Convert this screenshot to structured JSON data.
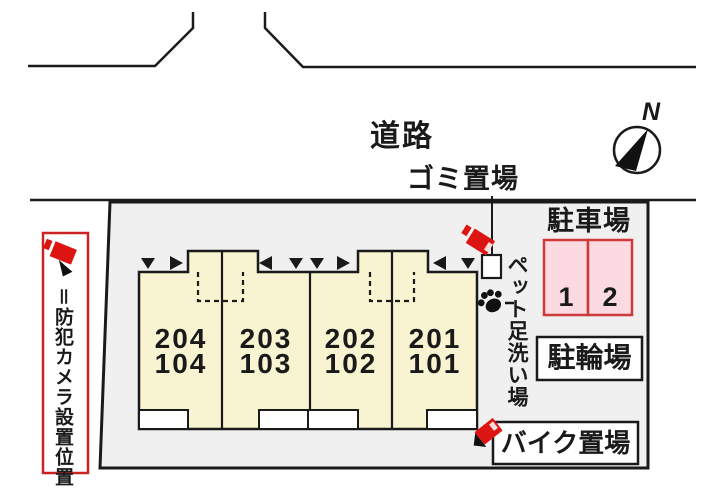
{
  "diagram": {
    "road_label": "道路",
    "garbage_label": "ゴミ置場",
    "north_label": "N",
    "parking": {
      "title": "駐車場",
      "spaces": [
        "1",
        "2"
      ]
    },
    "bicycle_label": "駐輪場",
    "bike_label": "バイク置場",
    "pet_wash_label": "ペット足洗い場",
    "legend_text": "＝防犯カメラ設置位置",
    "units": [
      {
        "upper": "204",
        "lower": "104"
      },
      {
        "upper": "203",
        "lower": "103"
      },
      {
        "upper": "202",
        "lower": "102"
      },
      {
        "upper": "201",
        "lower": "101"
      }
    ],
    "markers": [
      "down",
      "right",
      "left",
      "down",
      "down",
      "right",
      "left",
      "down"
    ],
    "icons": {
      "camera": "security-camera-icon",
      "paw": "paw-print-icon",
      "compass": "compass-north-icon"
    },
    "colors": {
      "site_fill": "#f0f0f0",
      "building_fill": "#f8f3d0",
      "parking_fill": "#fbdae2",
      "parking_border": "#ce3a3a",
      "camera_red": "#dd1512",
      "legend_border": "#cc2222",
      "line": "#1a1a1a"
    }
  }
}
